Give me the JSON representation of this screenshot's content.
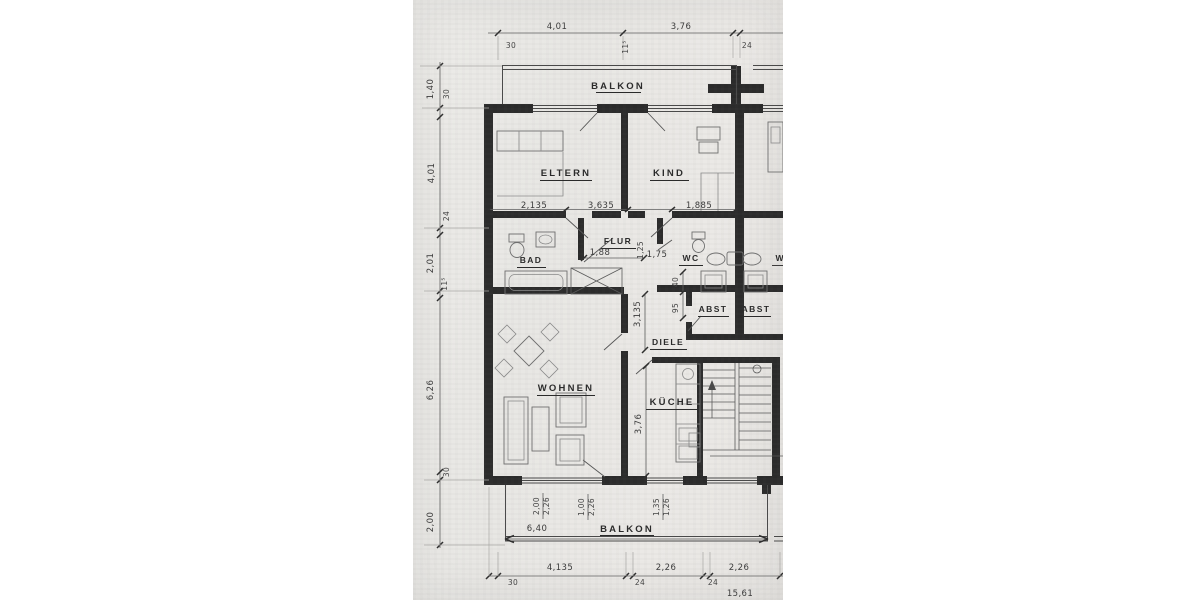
{
  "colors": {
    "paper": "#e9e8e5",
    "ink": "#2b2b2b",
    "wall": "#2d2d2d",
    "dimension": "#3b3b3b"
  },
  "rooms": {
    "balkon_top": "BALKON",
    "eltern": "ELTERN",
    "kind": "KIND",
    "flur": "FLUR",
    "bad": "BAD",
    "wc": "WC",
    "wc_neighbor": "WC",
    "abst_left": "ABST",
    "abst_right": "ABST",
    "diele": "DIELE",
    "wohnen": "WOHNEN",
    "kueche": "KÜCHE",
    "balkon_bottom": "BALKON"
  },
  "dims_top": {
    "d1": "4,01",
    "d2": "3,76",
    "s1": "30",
    "s2": "11⁵",
    "s3": "24"
  },
  "dims_left": {
    "d1": "1,40",
    "s1": "30",
    "d2": "4,01",
    "s2": "24",
    "d3": "2,01",
    "s3": "11⁵",
    "d4": "6,26",
    "s4": "30",
    "d5": "2,00"
  },
  "dims_rooms": {
    "eltern_a": "2,135",
    "eltern_b": "3,635",
    "kind_a": "1,885",
    "flur_a": "1,88",
    "flur_b": "1,25",
    "flur_c": "1,75",
    "diele_h": "3,135",
    "w40": "40",
    "w95": "95",
    "kueche_h": "3,76"
  },
  "dims_balkon": {
    "total": "6,40",
    "p1a": "2,00",
    "p1b": "2,26",
    "p2a": "1,00",
    "p2b": "2,26",
    "p3a": "1,35",
    "p3b": "1,26"
  },
  "dims_bottom": {
    "d1": "4,135",
    "d2": "2,26",
    "d3": "2,26",
    "s1": "30",
    "s2": "24",
    "s3": "24",
    "total": "15,61"
  }
}
